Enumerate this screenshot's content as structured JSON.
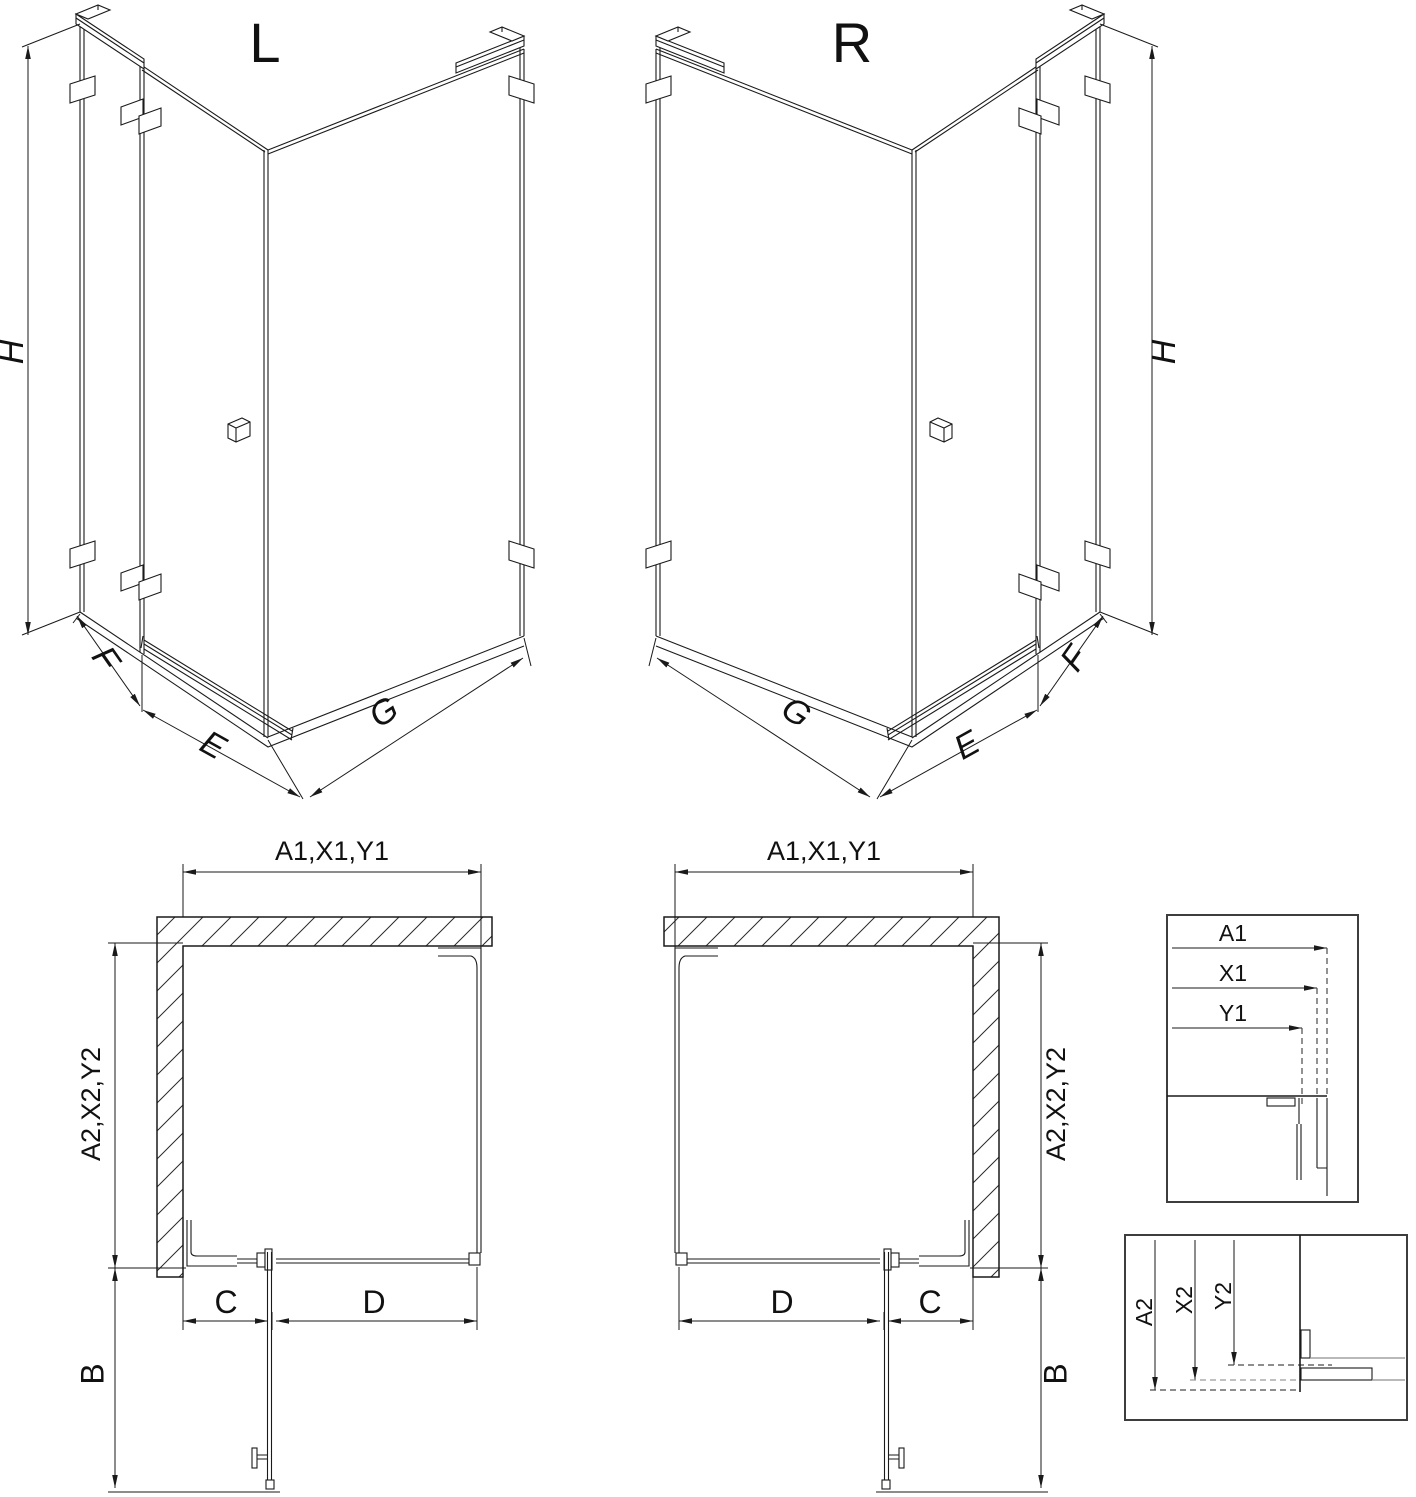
{
  "iso": {
    "left_label": "L",
    "right_label": "R",
    "dim_height": "H",
    "dim_return_panel": "F",
    "dim_door": "E",
    "dim_side_panel": "G"
  },
  "plan": {
    "dim_width": "A1,X1,Y1",
    "dim_depth": "A2,X2,Y2",
    "dim_door_swing": "B",
    "dim_fixed_segment": "C",
    "dim_door_width": "D"
  },
  "details": {
    "top": {
      "a1": "A1",
      "x1": "X1",
      "y1": "Y1"
    },
    "bottom": {
      "a2": "A2",
      "x2": "X2",
      "y2": "Y2"
    }
  },
  "colors": {
    "line": "#1a1a1a",
    "detail_frame": "#3d3d3d",
    "gray_line": "#8f8f8f",
    "background": "#ffffff"
  }
}
